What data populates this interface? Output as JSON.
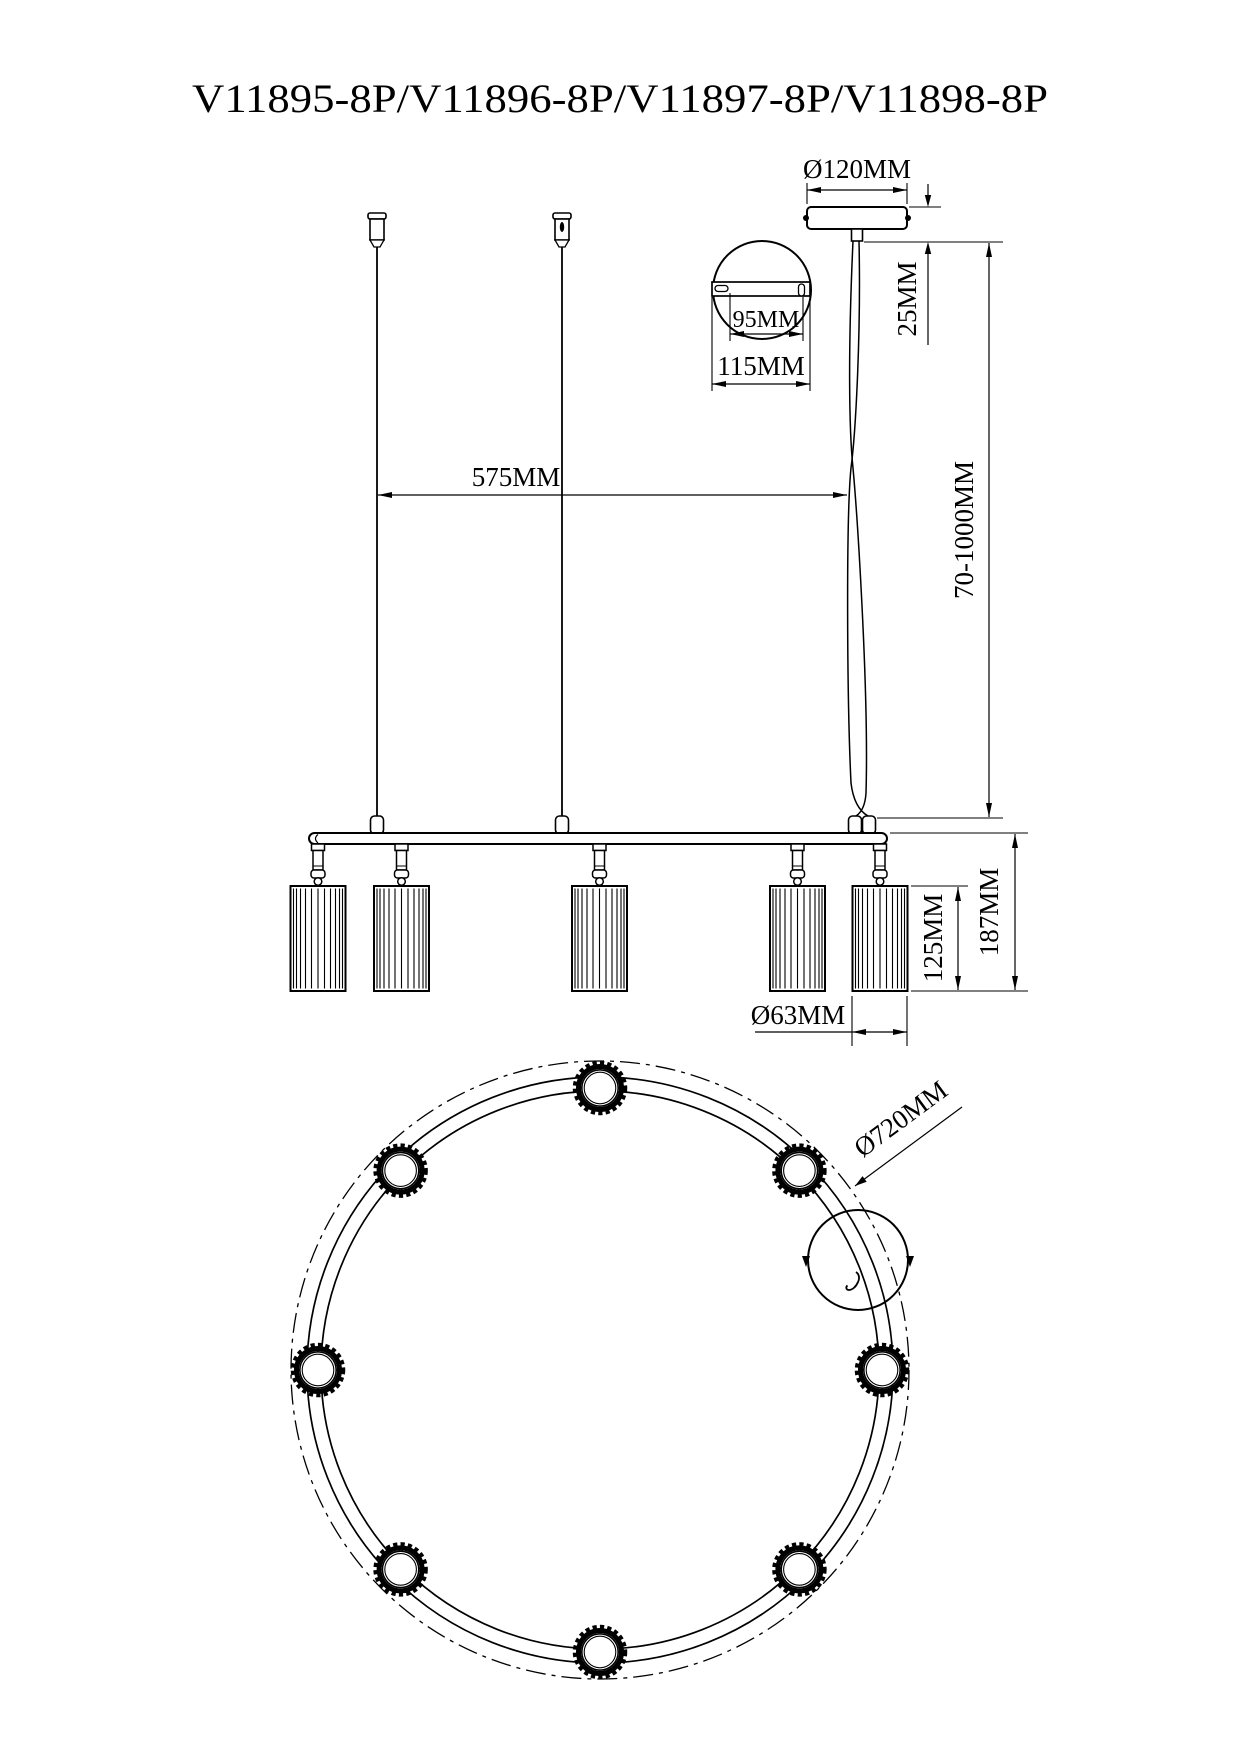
{
  "title": "V11895-8P/V11896-8P/V11897-8P/V11898-8P",
  "drawing_type": "pendant lamp installation dimension drawing",
  "dims": {
    "canopy_diameter": "Ø120MM",
    "canopy_height": "25MM",
    "keyhole_spacing": "95MM",
    "plate_width": "115MM",
    "suspension_spread": "575MM",
    "cable_range": "70-1000MM",
    "fixture_drop": "187MM",
    "shade_height": "125MM",
    "shade_diameter": "Ø63MM",
    "ring_diameter": "Ø720MM"
  },
  "counts": {
    "shades_in_elevation": 5,
    "shades_in_plan": 8
  }
}
